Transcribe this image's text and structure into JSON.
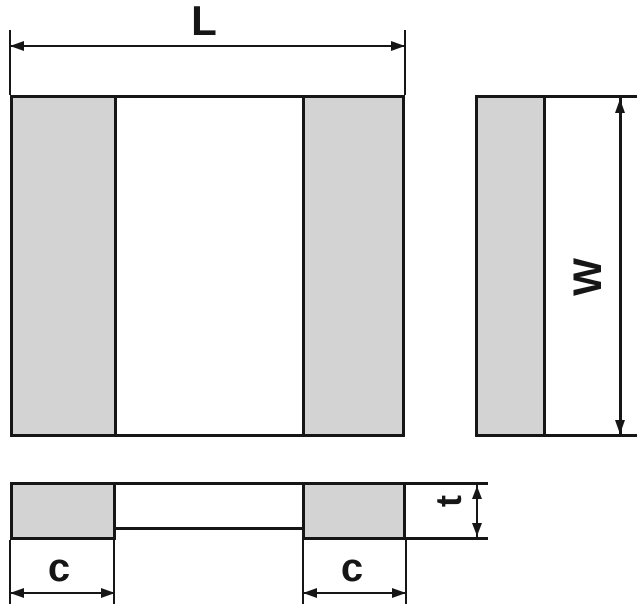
{
  "diagram": {
    "labels": {
      "length": "L",
      "width": "W",
      "thickness": "t",
      "terminal_left": "c",
      "terminal_right": "c"
    },
    "colors": {
      "line": "#161616",
      "pad": "#d3d3d3",
      "background": "#ffffff"
    }
  }
}
